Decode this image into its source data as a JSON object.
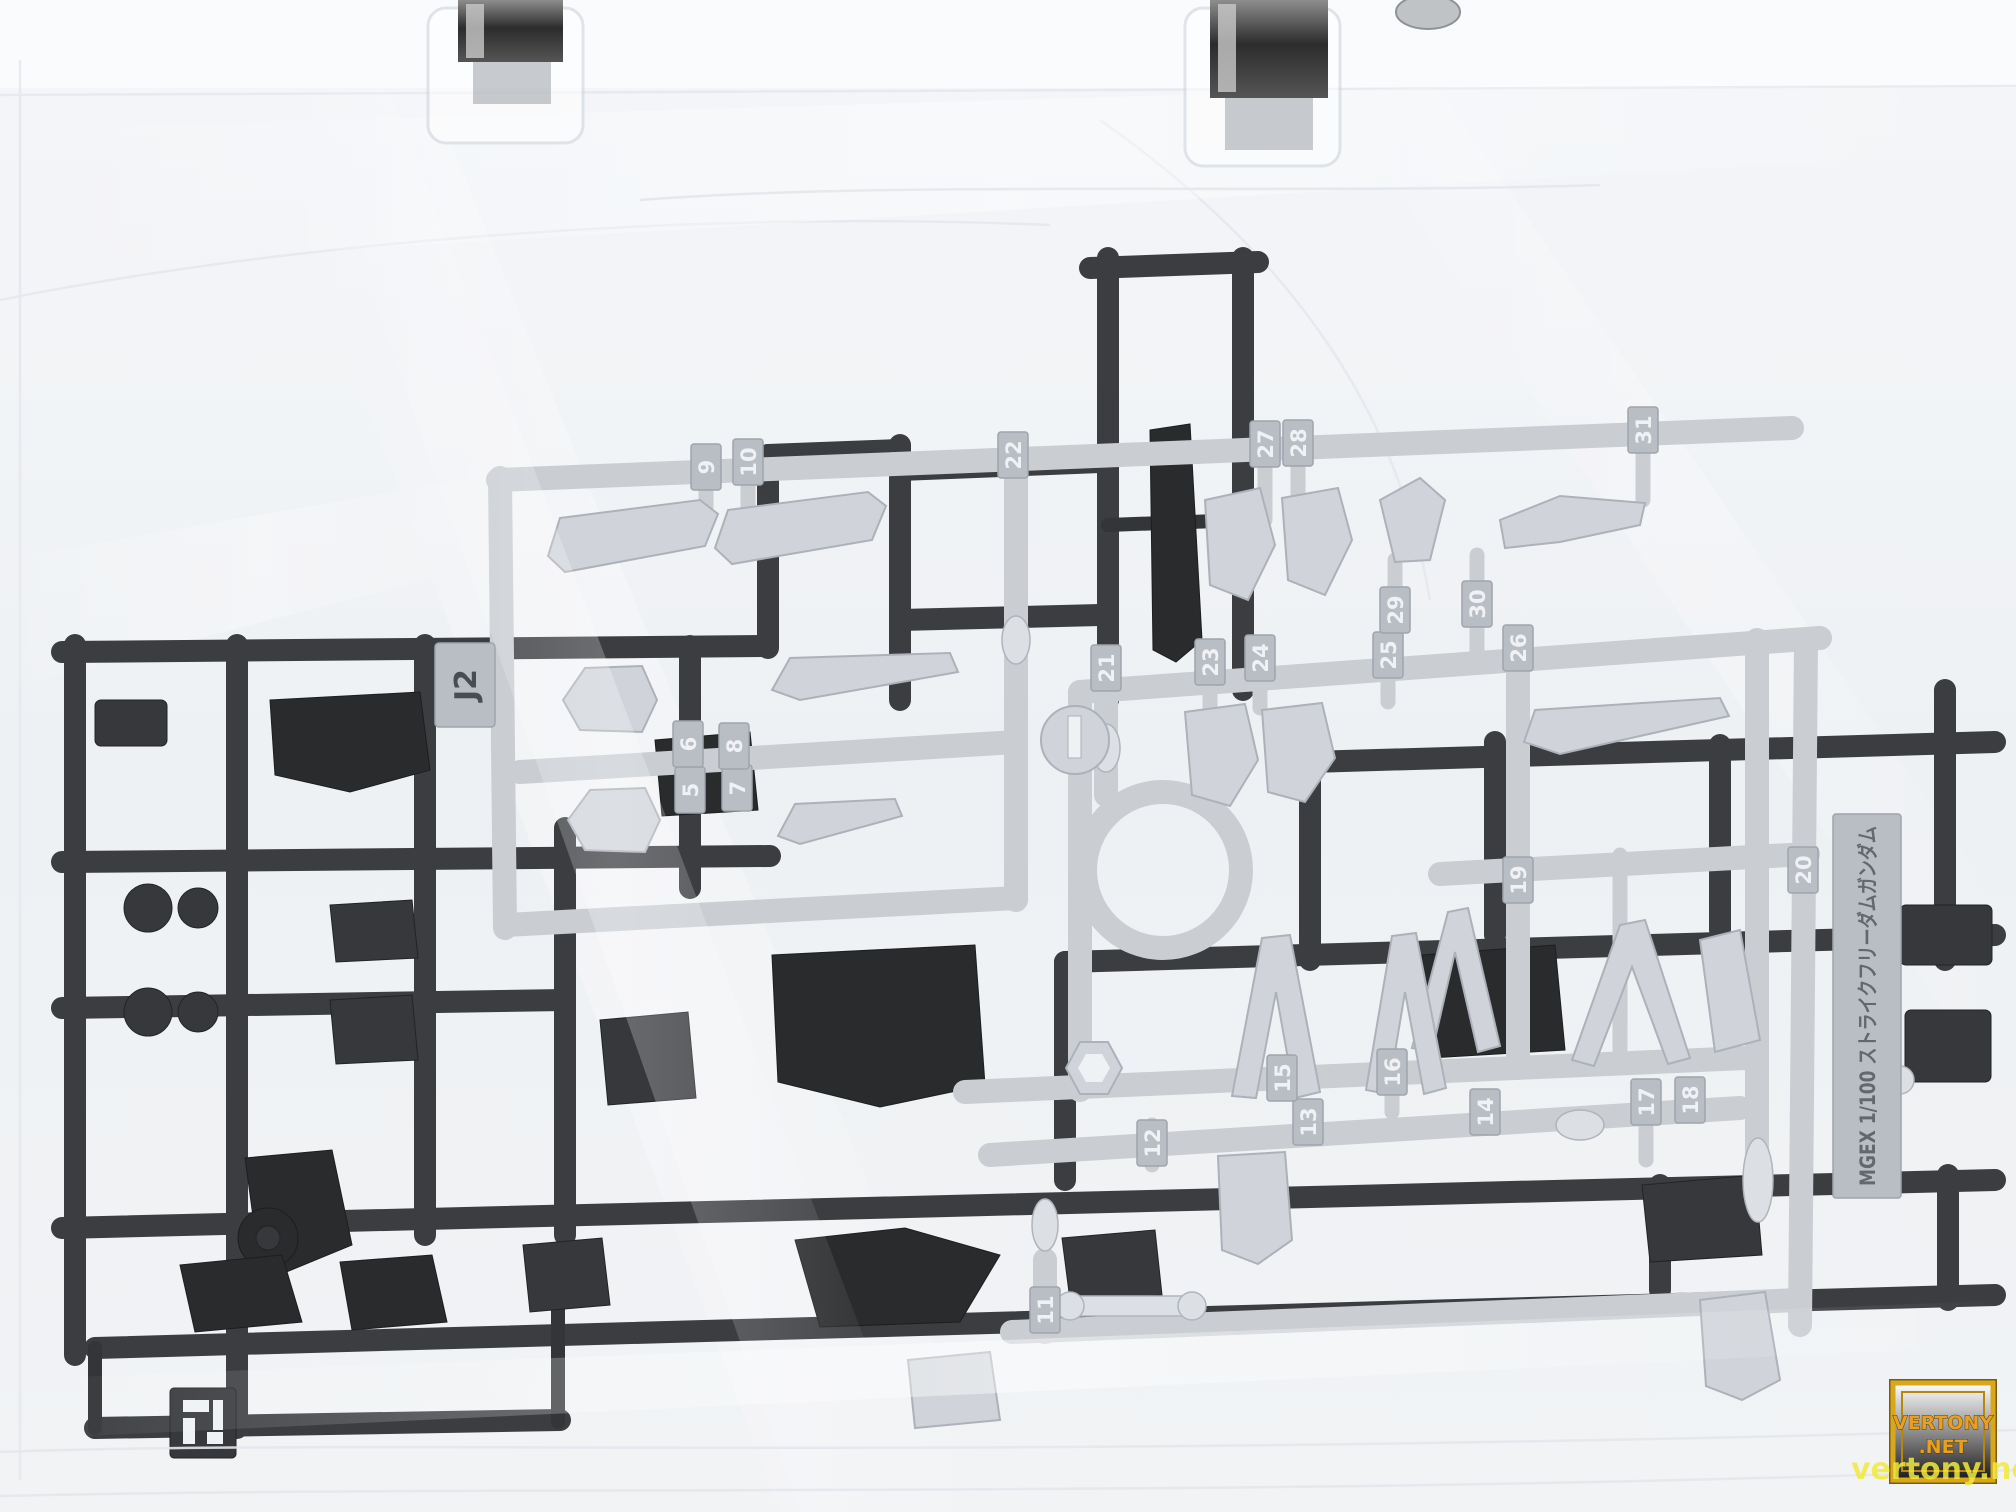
{
  "photo_subject": "plastic model runners in clear hanging bag",
  "colors": {
    "bag": "#eef1f5",
    "bag_highlight": "#fbfcfe",
    "light_plastic": "#c6cad0",
    "light_plastic_part": "#cdd1d7",
    "dark_plastic": "#2b2d31",
    "dark_plastic_part": "#17191c",
    "tab_text": "#eef0f3",
    "label_text": "#565b63",
    "watermark_gold": "#e8a020",
    "watermark_yellow": "#f2ea3d"
  },
  "light_runner": {
    "code": "J2",
    "tabs": [
      "5",
      "6",
      "7",
      "8",
      "9",
      "10",
      "11",
      "12",
      "13",
      "14",
      "15",
      "16",
      "17",
      "18",
      "19",
      "20",
      "21",
      "22",
      "23",
      "24",
      "25",
      "26",
      "27",
      "28",
      "29",
      "30",
      "31"
    ]
  },
  "label_plate": {
    "text": "MGEX 1/100 ストライクフリーダムガンダム"
  },
  "watermark": {
    "badge_line1": "VERTONY",
    "badge_line2": ".NET",
    "overlay": "vertony.net"
  }
}
